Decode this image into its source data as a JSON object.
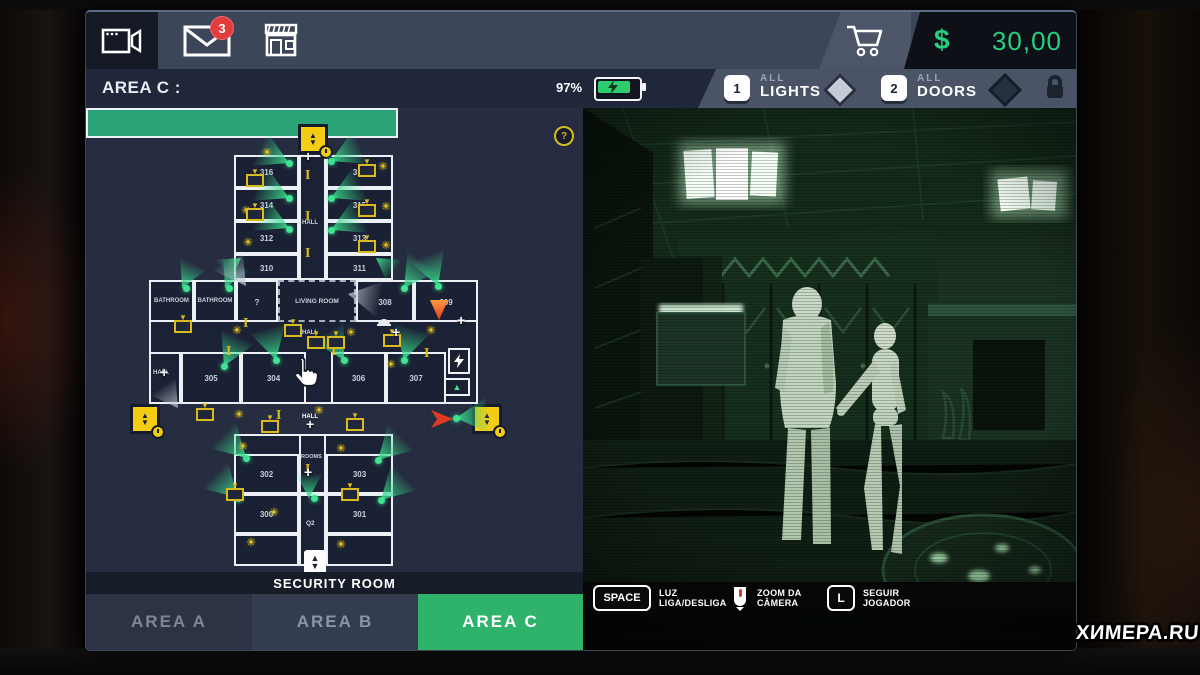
{
  "colors": {
    "accent_green": "#2fb36b",
    "money_green": "#27cf7f",
    "badge_red": "#e23c3c",
    "map_yellow": "#f2cd13",
    "hall_green": "#2aa376"
  },
  "top_bar": {
    "mail_badge": "3",
    "currency": "$",
    "balance": "30,00"
  },
  "area_bar": {
    "title": "AREA C :",
    "battery": "97%",
    "lights_key": "1",
    "lights_all": "ALL",
    "lights_label": "LIGHTS",
    "doors_key": "2",
    "doors_all": "ALL",
    "doors_label": "DOORS"
  },
  "map": {
    "help": "?",
    "security_room": "SECURITY ROOM",
    "living_room": "LIVING ROOM",
    "bathroom_a": "BATHROOM",
    "bathroom_b": "BATHROOM",
    "unknown": "?",
    "q2": "Q2",
    "rooms_label": "ROOMS",
    "hall_top": "HALL",
    "hall_mid": "HALL",
    "hall_left": "HALL",
    "hall_green": "HALL",
    "rooms": {
      "r316": "316",
      "r317": "317",
      "r314": "314",
      "r315": "315",
      "r312": "312",
      "r313": "313",
      "r310": "310",
      "r311": "311",
      "r308": "308",
      "r309": "309",
      "r305": "305",
      "r304": "304",
      "r306": "306",
      "r307": "307",
      "r302": "302",
      "r303": "303",
      "r300": "300",
      "r301": "301"
    }
  },
  "tabs": {
    "a": "AREA A",
    "b": "AREA B",
    "c": "AREA C"
  },
  "controls": {
    "light_key": "SPACE",
    "light_1": "LUZ",
    "light_2": "LIGA/DESLIGA",
    "zoom_1": "ZOOM DA",
    "zoom_2": "CÂMERA",
    "follow_key": "L",
    "follow_1": "SEGUIR",
    "follow_2": "JOGADOR"
  },
  "icons": {
    "sun": "☀",
    "up": "▲",
    "down": "▼",
    "plus": "+"
  },
  "watermark": "XИMEPA.RU"
}
